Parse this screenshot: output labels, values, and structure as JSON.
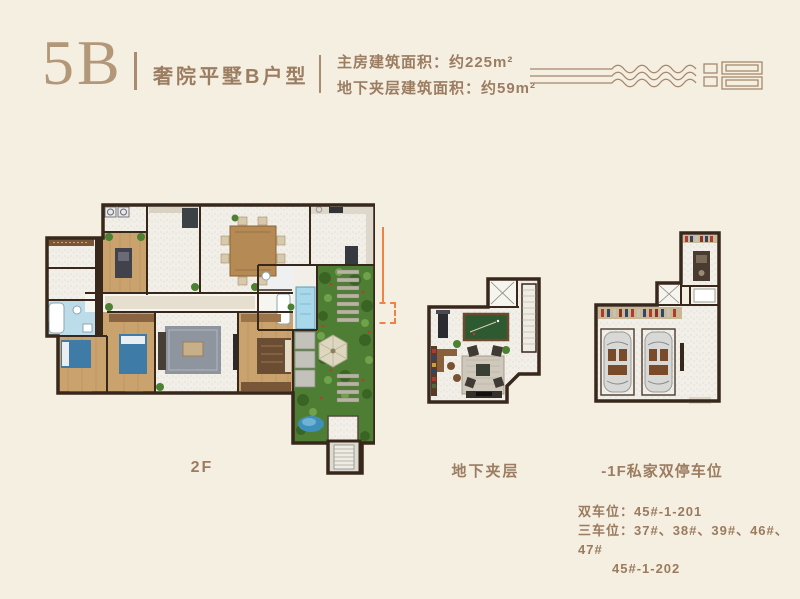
{
  "header": {
    "unit_code": "5B",
    "unit_name": "奢院平墅B户型",
    "area_line1": "主房建筑面积：约225m²",
    "area_line2": "地下夹层建筑面积：约59m²"
  },
  "note": {
    "text": "注：45#东户为东向门"
  },
  "plans": [
    {
      "id": "2f",
      "label": "2F"
    },
    {
      "id": "mezzanine",
      "label": "地下夹层"
    },
    {
      "id": "parking",
      "label": "-1F私家双停车位"
    }
  ],
  "parking_info": {
    "line1": "双车位：45#-1-201",
    "line2": "三车位：37#、38#、39#、46#、47#",
    "line3": "45#-1-202"
  },
  "colors": {
    "background": "#f5efe1",
    "brand_brown": "#a5876b",
    "text_brown": "#9b7d62",
    "accent_orange": "#ef8345",
    "wall_dark": "#38271b",
    "wood_floor": "#c9a26e",
    "garden_green": "#4e7e33",
    "water_blue": "#a8d8ea",
    "billiard_green": "#2e5a31"
  }
}
